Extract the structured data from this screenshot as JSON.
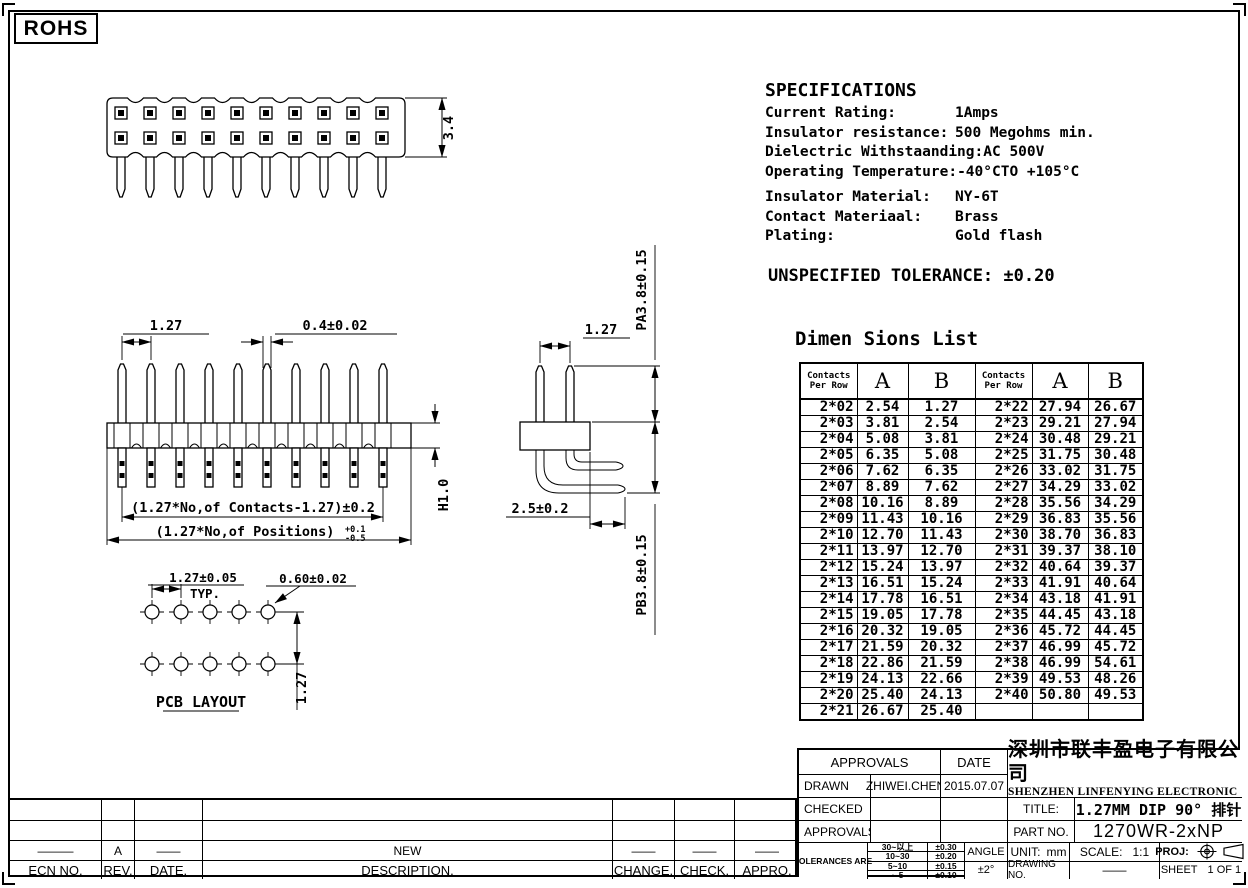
{
  "page": {
    "rohs_label": "ROHS"
  },
  "specs": {
    "title": "SPECIFICATIONS",
    "rows": [
      {
        "label": "Current Rating:",
        "value": "1Amps"
      },
      {
        "label": "Insulator resistance:",
        "value": "500 Megohms min."
      },
      {
        "label": "Dielectric Withstaanding:",
        "value": "AC 500V"
      },
      {
        "label": "Operating Temperature:",
        "value": "-40°CTO +105°C"
      },
      {
        "label": "Insulator Material:",
        "value": "NY-6T"
      },
      {
        "label": "Contact Materiaal:",
        "value": "Brass"
      },
      {
        "label": "Plating:",
        "value": "Gold flash"
      }
    ],
    "unspecified_tolerance": "UNSPECIFIED TOLERANCE: ±0.20"
  },
  "drawings": {
    "top_view": {
      "height_dim": "3.4"
    },
    "front_view": {
      "pitch_dim": "1.27",
      "pin_width_dim": "0.4±0.02",
      "body_height_dim": "H1.0",
      "contacts_span_dim": "(1.27*No,of Contacts-1.27)±0.2",
      "positions_span_dim": "(1.27*No,of Positions)",
      "positions_tol_upper": "+0.1",
      "positions_tol_lower": "-0.5"
    },
    "side_view": {
      "pitch_dim": "1.27",
      "pa_dim": "PA3.8±0.15",
      "pb_dim": "PB3.8±0.15",
      "tail_dim": "2.5±0.2"
    },
    "pcb_layout": {
      "title": "PCB LAYOUT",
      "pitch_dim": "1.27±0.05",
      "typ_label": "TYP.",
      "hole_dim": "0.60±0.02",
      "row_pitch_dim": "1.27"
    }
  },
  "dim_table": {
    "title": "Dimen Sions List",
    "col_headers": {
      "contacts_line1": "Contacts",
      "contacts_line2": "Per  Row",
      "a": "A",
      "b": "B"
    },
    "left_rows": [
      [
        "2*02",
        "2.54",
        "1.27"
      ],
      [
        "2*03",
        "3.81",
        "2.54"
      ],
      [
        "2*04",
        "5.08",
        "3.81"
      ],
      [
        "2*05",
        "6.35",
        "5.08"
      ],
      [
        "2*06",
        "7.62",
        "6.35"
      ],
      [
        "2*07",
        "8.89",
        "7.62"
      ],
      [
        "2*08",
        "10.16",
        "8.89"
      ],
      [
        "2*09",
        "11.43",
        "10.16"
      ],
      [
        "2*10",
        "12.70",
        "11.43"
      ],
      [
        "2*11",
        "13.97",
        "12.70"
      ],
      [
        "2*12",
        "15.24",
        "13.97"
      ],
      [
        "2*13",
        "16.51",
        "15.24"
      ],
      [
        "2*14",
        "17.78",
        "16.51"
      ],
      [
        "2*15",
        "19.05",
        "17.78"
      ],
      [
        "2*16",
        "20.32",
        "19.05"
      ],
      [
        "2*17",
        "21.59",
        "20.32"
      ],
      [
        "2*18",
        "22.86",
        "21.59"
      ],
      [
        "2*19",
        "24.13",
        "22.66"
      ],
      [
        "2*20",
        "25.40",
        "24.13"
      ],
      [
        "2*21",
        "26.67",
        "25.40"
      ]
    ],
    "right_rows": [
      [
        "2*22",
        "27.94",
        "26.67"
      ],
      [
        "2*23",
        "29.21",
        "27.94"
      ],
      [
        "2*24",
        "30.48",
        "29.21"
      ],
      [
        "2*25",
        "31.75",
        "30.48"
      ],
      [
        "2*26",
        "33.02",
        "31.75"
      ],
      [
        "2*27",
        "34.29",
        "33.02"
      ],
      [
        "2*28",
        "35.56",
        "34.29"
      ],
      [
        "2*29",
        "36.83",
        "35.56"
      ],
      [
        "2*30",
        "38.70",
        "36.83"
      ],
      [
        "2*31",
        "39.37",
        "38.10"
      ],
      [
        "2*32",
        "40.64",
        "39.37"
      ],
      [
        "2*33",
        "41.91",
        "40.64"
      ],
      [
        "2*34",
        "43.18",
        "41.91"
      ],
      [
        "2*35",
        "44.45",
        "43.18"
      ],
      [
        "2*36",
        "45.72",
        "44.45"
      ],
      [
        "2*37",
        "46.99",
        "45.72"
      ],
      [
        "2*38",
        "46.99",
        "54.61"
      ],
      [
        "2*39",
        "49.53",
        "48.26"
      ],
      [
        "2*40",
        "50.80",
        "49.53"
      ],
      [
        "",
        "",
        ""
      ]
    ]
  },
  "title_block": {
    "approvals_header": "APPROVALS",
    "date_header": "DATE",
    "signature_rows": [
      {
        "label": "DRAWN",
        "name": "ZHIWEI.CHEN",
        "date": "2015.07.07"
      },
      {
        "label": "CHECKED",
        "name": "",
        "date": ""
      },
      {
        "label": "APPROVALS",
        "name": "",
        "date": ""
      }
    ],
    "tolerances_label": "TOLERANCES ARE",
    "tolerance_rows": [
      [
        "30~以上",
        "±0.30"
      ],
      [
        "10~30",
        "±0.20"
      ],
      [
        "5~10",
        "±0.15"
      ],
      [
        "~ 5",
        "±0.10"
      ]
    ],
    "angle_header": "ANGLE",
    "angle_value": "±2°",
    "company_cn": "深圳市联丰盈电子有限公司",
    "company_en": "SHENZHEN LINFENYING ELECTRONIC CO.,LTD",
    "title_label": "TITLE:",
    "title_value": "1.27MM DIP 90°  排针",
    "part_label": "PART  NO.",
    "part_value": "1270WR-2xNP",
    "unit_label": "UNIT:",
    "unit_value": "mm",
    "scale_label": "SCALE:",
    "scale_value": "1:1",
    "proj_label": "PROJ:",
    "drawing_no_label": "DRAWING  NO.",
    "drawing_no_value": "——",
    "sheet_label": "SHEET",
    "sheet_value": "1  OF  1"
  },
  "revision_block": {
    "data_rows": [
      [
        "",
        "",
        "",
        "",
        "",
        "",
        ""
      ],
      [
        "",
        "",
        "",
        "",
        "",
        "",
        ""
      ],
      [
        "———",
        "A",
        "——",
        "NEW",
        "——",
        "——",
        "——"
      ]
    ],
    "header_row": [
      "ECN  NO.",
      "REV.",
      "DATE.",
      "DESCRIPTION.",
      "CHANGE.",
      "CHECK.",
      "APPRO."
    ]
  }
}
